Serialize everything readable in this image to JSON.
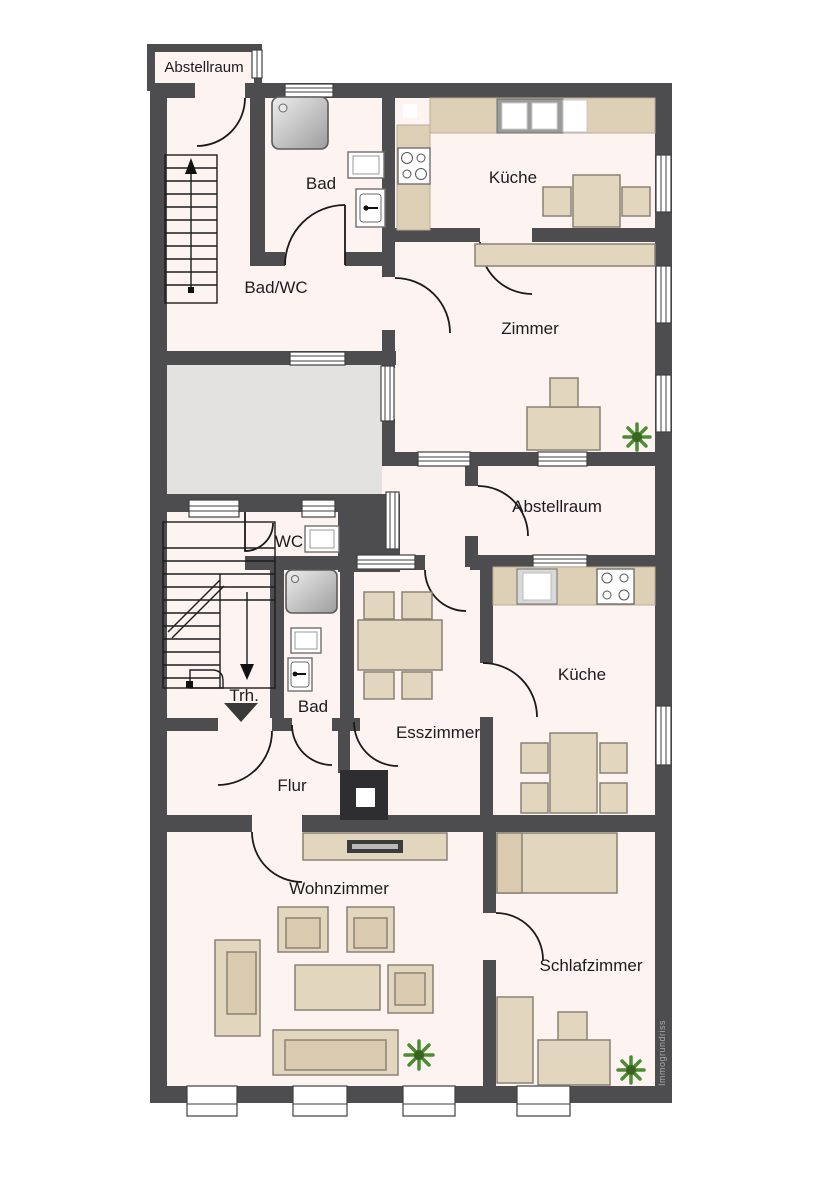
{
  "plan": {
    "watermark": "Immogrundriss",
    "rooms": [
      {
        "id": "abstellraum-top",
        "label": "Abstellraum"
      },
      {
        "id": "bad-1",
        "label": "Bad"
      },
      {
        "id": "kueche-1",
        "label": "Küche"
      },
      {
        "id": "bad-wc",
        "label": "Bad/WC"
      },
      {
        "id": "zimmer",
        "label": "Zimmer"
      },
      {
        "id": "abstellraum-2",
        "label": "Abstellraum"
      },
      {
        "id": "wc",
        "label": "WC"
      },
      {
        "id": "treppenhaus",
        "label": "Trh."
      },
      {
        "id": "bad-2",
        "label": "Bad"
      },
      {
        "id": "esszimmer",
        "label": "Esszimmer"
      },
      {
        "id": "kueche-2",
        "label": "Küche"
      },
      {
        "id": "flur",
        "label": "Flur"
      },
      {
        "id": "wohnzimmer",
        "label": "Wohnzimmer"
      },
      {
        "id": "schlafzimmer",
        "label": "Schlafzimmer"
      }
    ],
    "colors": {
      "wall": "#4d4c4e",
      "room_fill": "#fdf4f2",
      "stairwell_gray": "#e3e2e1",
      "furniture": "#e3d6bf",
      "plant_green": "#4e8c33"
    }
  }
}
